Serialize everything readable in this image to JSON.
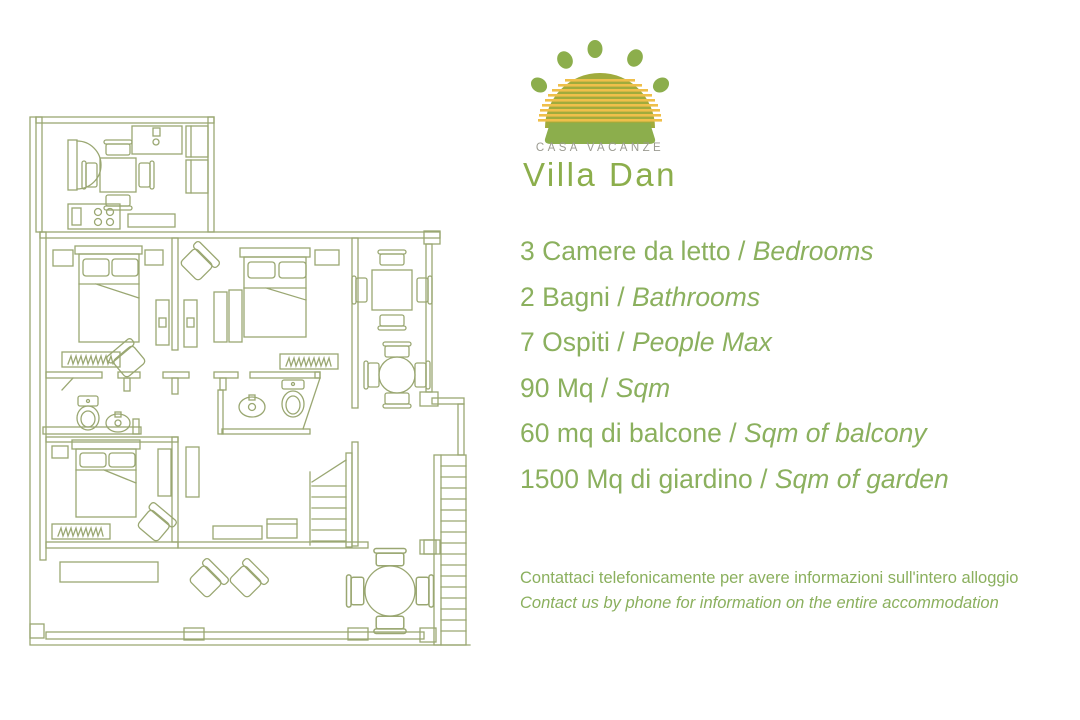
{
  "brand": {
    "tagline": "CASA VACANZE",
    "name": "Villa Dan"
  },
  "features": [
    {
      "it": "3 Camere da letto",
      "sep": " / ",
      "en": "Bedrooms"
    },
    {
      "it": "2 Bagni",
      "sep": " / ",
      "en": "Bathrooms"
    },
    {
      "it": "7 Ospiti",
      "sep": " / ",
      "en": "People Max"
    },
    {
      "it": "90 Mq",
      "sep": " / ",
      "en": "Sqm"
    },
    {
      "it": "60 mq di balcone",
      "sep": " / ",
      "en": "Sqm of balcony"
    },
    {
      "it": "1500 Mq di giardino",
      "sep": " / ",
      "en": "Sqm of garden"
    }
  ],
  "contact": {
    "it": "Contattaci telefonicamente per avere informazioni sull'intero alloggio",
    "en": "Contact us by phone for information on the entire accommodation"
  },
  "colors": {
    "text_green": "#8bb05e",
    "plan_line": "#9aa772",
    "logo_dome_green": "#a0ab3c",
    "logo_stripe_yellow": "#efbf4a",
    "logo_solid_green": "#8cae4c",
    "tagline_gray": "#9b9b91"
  }
}
